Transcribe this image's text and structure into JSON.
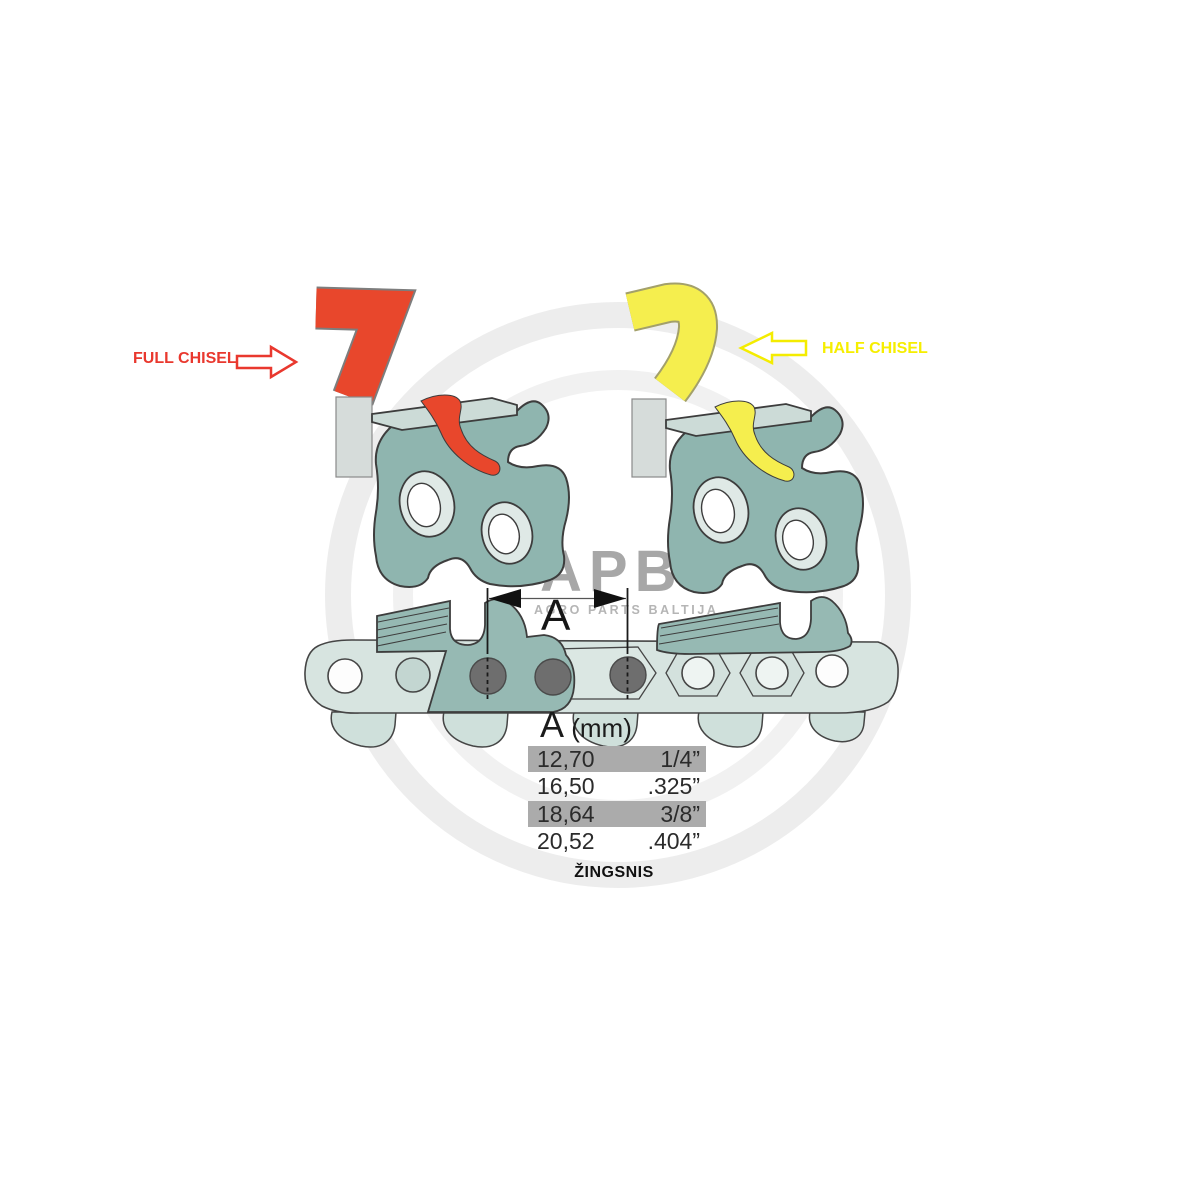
{
  "labels": {
    "full_chisel": "FULL CHISEL",
    "half_chisel": "HALF CHISEL",
    "dimension_letter": "A",
    "pitch_caption": "ŽINGSNIS"
  },
  "table": {
    "header": {
      "letter": "A",
      "unit": " (mm)"
    },
    "rows": [
      {
        "mm": "12,70",
        "inch": "1/4”",
        "highlighted": true
      },
      {
        "mm": "16,50",
        "inch": ".325”",
        "highlighted": false
      },
      {
        "mm": "18,64",
        "inch": "3/8”",
        "highlighted": true
      },
      {
        "mm": "20,52",
        "inch": ".404”",
        "highlighted": false
      }
    ],
    "highlight_color": "#ababab"
  },
  "watermark": {
    "logo": "APB",
    "subtitle": "AGRO PARTS BALTIJA"
  },
  "colors": {
    "full_chisel_red": "#e8472c",
    "half_chisel_yellow": "#f5ee4e",
    "label_red": "#e9382e",
    "label_yellow": "#f4ec00",
    "link_body_teal": "#8fb5af",
    "chain_strap": "#d7e4e0",
    "rivet_dark": "#6e6e6e",
    "watermark_gray": "#ededed"
  }
}
